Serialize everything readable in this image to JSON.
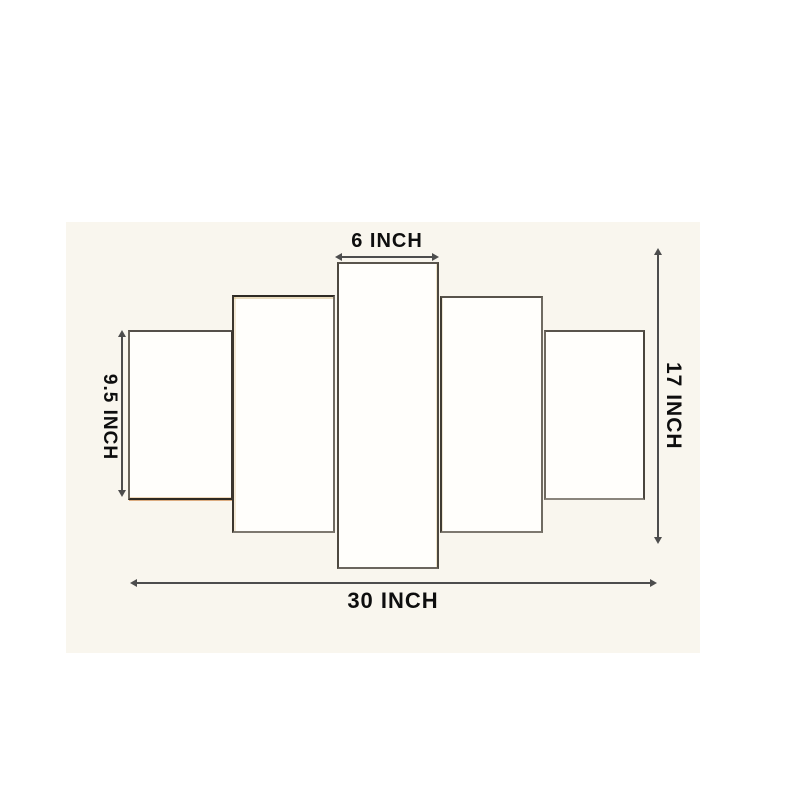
{
  "diagram": {
    "type": "product-dimension-diagram",
    "subject": "5 panel wall art set",
    "panel_count": 5,
    "panels": [
      {
        "name": "outer-left-panel"
      },
      {
        "name": "mid-left-panel"
      },
      {
        "name": "center-panel"
      },
      {
        "name": "mid-right-panel"
      },
      {
        "name": "outer-right-panel"
      }
    ],
    "measurements": {
      "top": {
        "label": "6 INCH"
      },
      "left": {
        "label": "9.5 INCH"
      },
      "right": {
        "label": "17 INCH"
      },
      "bottom": {
        "label": "30 INCH"
      }
    },
    "colors": {
      "page_background": "#ffffff",
      "diagram_background": "#f9f6ee",
      "panel_fill": "#fffefb",
      "panel_border": "#4b463e",
      "dimension_line": "#4d4d4d",
      "label_text": "#0e0e0e",
      "canvas_edge_accent": "#c47026"
    }
  }
}
